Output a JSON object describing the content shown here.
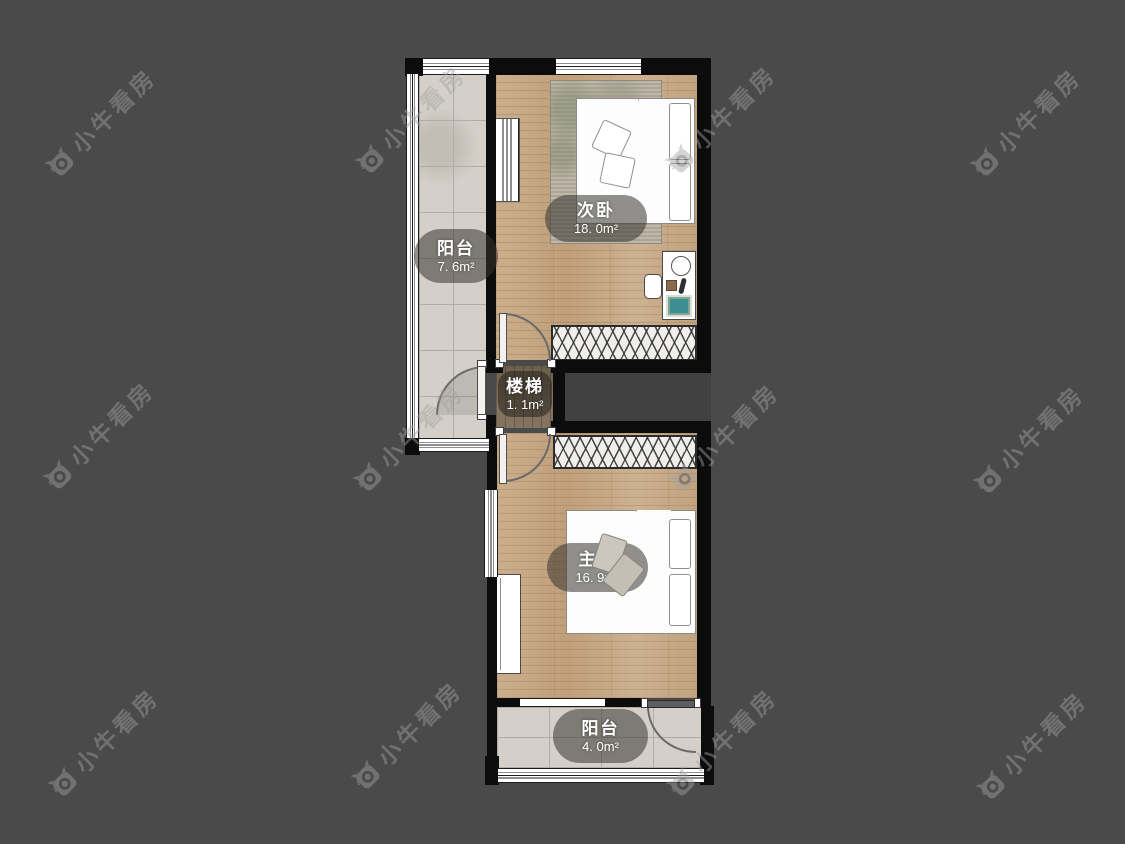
{
  "app": {
    "watermark_text": "小牛看房"
  },
  "floorplan": {
    "rooms": [
      {
        "key": "balcony-left",
        "name": "阳台",
        "area": "7. 6m²"
      },
      {
        "key": "bedroom-secondary",
        "name": "次卧",
        "area": "18. 0m²"
      },
      {
        "key": "stairs",
        "name": "楼梯",
        "area": "1. 1m²"
      },
      {
        "key": "bedroom-master",
        "name": "主卧",
        "area": "16. 9m²"
      },
      {
        "key": "balcony-bottom",
        "name": "阳台",
        "area": "4. 0m²"
      }
    ],
    "colors": {
      "background": "#4a4a4a",
      "wall": "#0c0c0c",
      "wood_floor": "#c6a783",
      "tile_floor": "#d4d0c9",
      "stair_floor": "#84735f",
      "label_background": "rgba(55,52,48,0.55)",
      "label_text": "#ffffff",
      "watermark": "#a2a2a2",
      "artwork_teal": "#3d8d94"
    }
  }
}
